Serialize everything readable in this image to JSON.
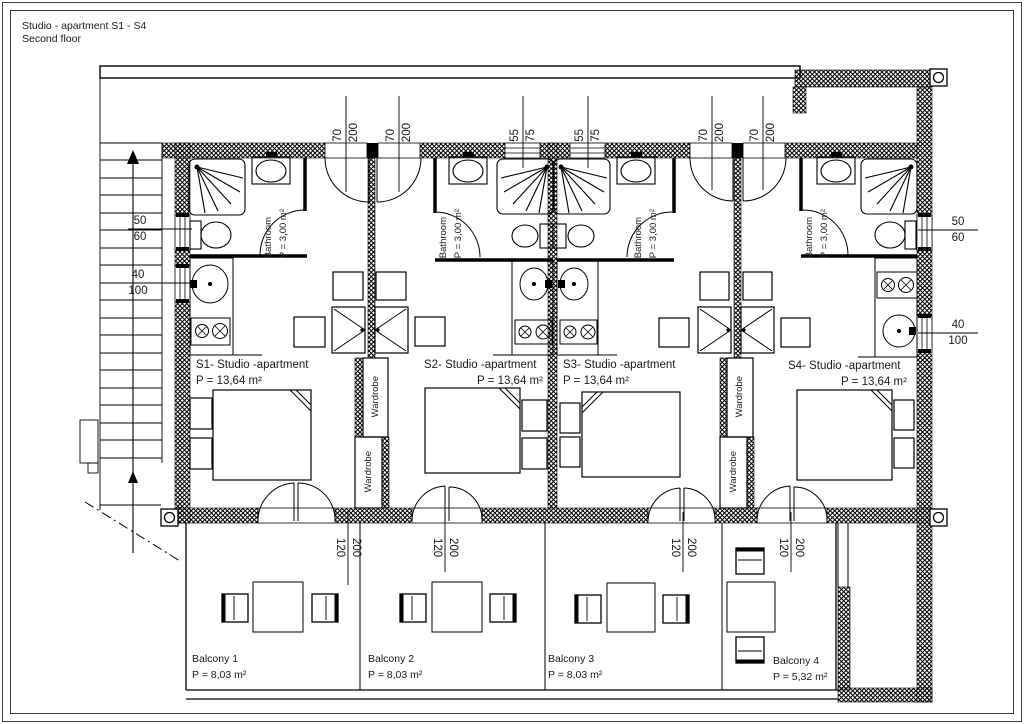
{
  "title": {
    "line1": "Studio - apartment S1 - S4",
    "line2": "Second floor"
  },
  "apartments": [
    {
      "name": "S1- Studio -apartment",
      "area": "P = 13,64 m²"
    },
    {
      "name": "S2- Studio -apartment",
      "area": "P = 13,64 m²"
    },
    {
      "name": "S3- Studio -apartment",
      "area": "P = 13,64 m²"
    },
    {
      "name": "S4- Studio -apartment",
      "area": "P = 13,64 m²"
    }
  ],
  "bathroom": {
    "label": "Bathroom",
    "area": "P = 3,00 m²"
  },
  "wardrobe_label": "Wardrobe",
  "balconies": [
    {
      "name": "Balcony 1",
      "area": "P = 8,03 m²"
    },
    {
      "name": "Balcony 2",
      "area": "P = 8,03 m²"
    },
    {
      "name": "Balcony 3",
      "area": "P = 8,03 m²"
    },
    {
      "name": "Balcony 4",
      "area": "P = 5,32 m²"
    }
  ],
  "dimensions": {
    "top": [
      {
        "num": "70",
        "den": "200"
      },
      {
        "num": "70",
        "den": "200"
      },
      {
        "num": "55",
        "den": "75"
      },
      {
        "num": "55",
        "den": "75"
      },
      {
        "num": "70",
        "den": "200"
      },
      {
        "num": "70",
        "den": "200"
      }
    ],
    "left": [
      {
        "num": "50",
        "den": "60"
      },
      {
        "num": "40",
        "den": "100"
      }
    ],
    "right": [
      {
        "num": "50",
        "den": "60"
      },
      {
        "num": "40",
        "den": "100"
      }
    ],
    "balcony_doors": [
      {
        "num": "200",
        "den": "120"
      },
      {
        "num": "200",
        "den": "120"
      },
      {
        "num": "200",
        "den": "120"
      },
      {
        "num": "200",
        "den": "120"
      }
    ]
  }
}
